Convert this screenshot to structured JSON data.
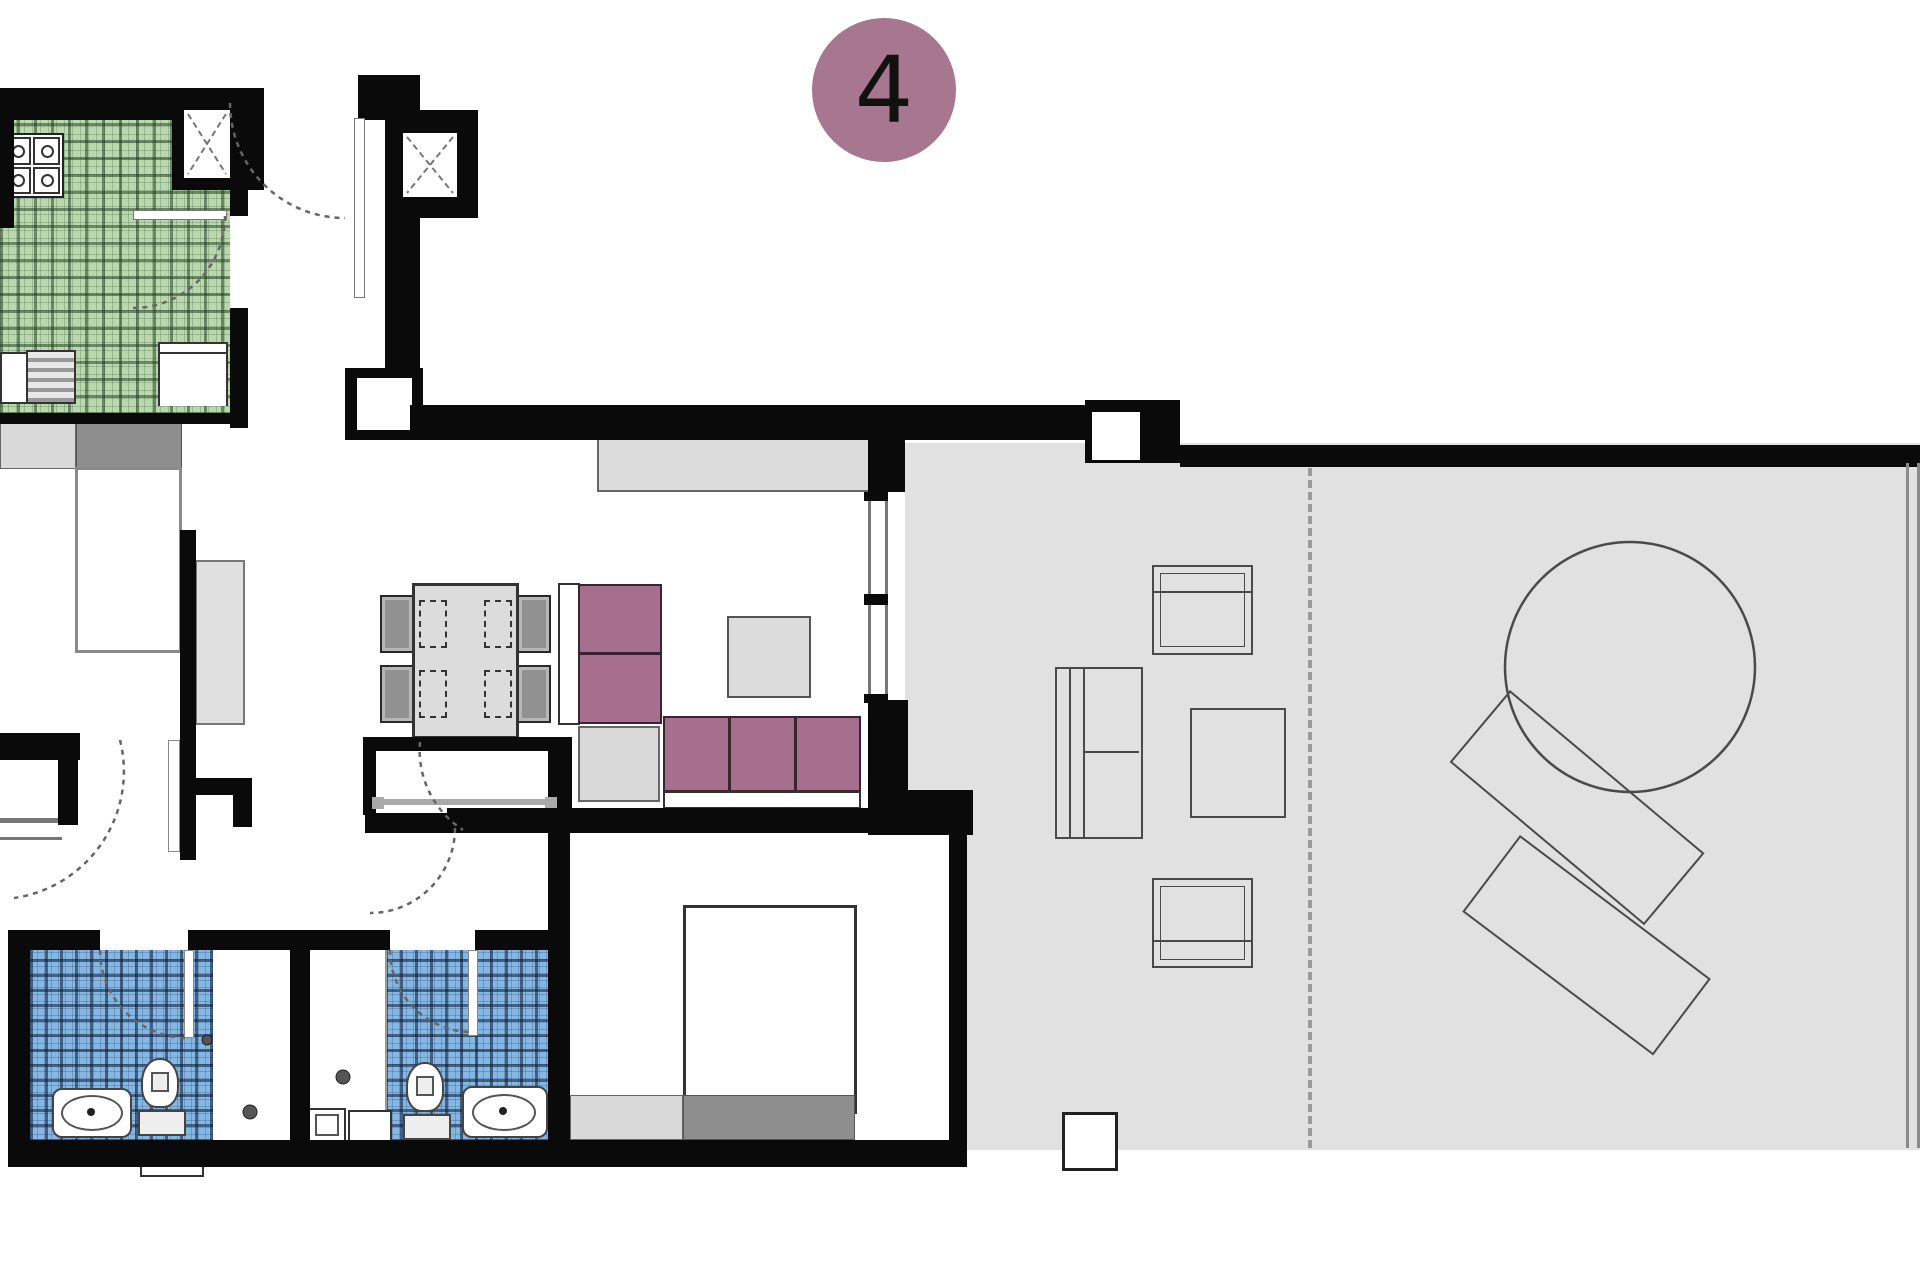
{
  "badge": {
    "label": "4"
  },
  "colors": {
    "badge_bg": "#a7768f",
    "sofa": "#a56f8d",
    "kitchen_tile": "#b9d8ae",
    "bath_tile": "#85b7e3",
    "terrace_floor": "#e1e1e1",
    "wall": "#0a0a0a"
  }
}
